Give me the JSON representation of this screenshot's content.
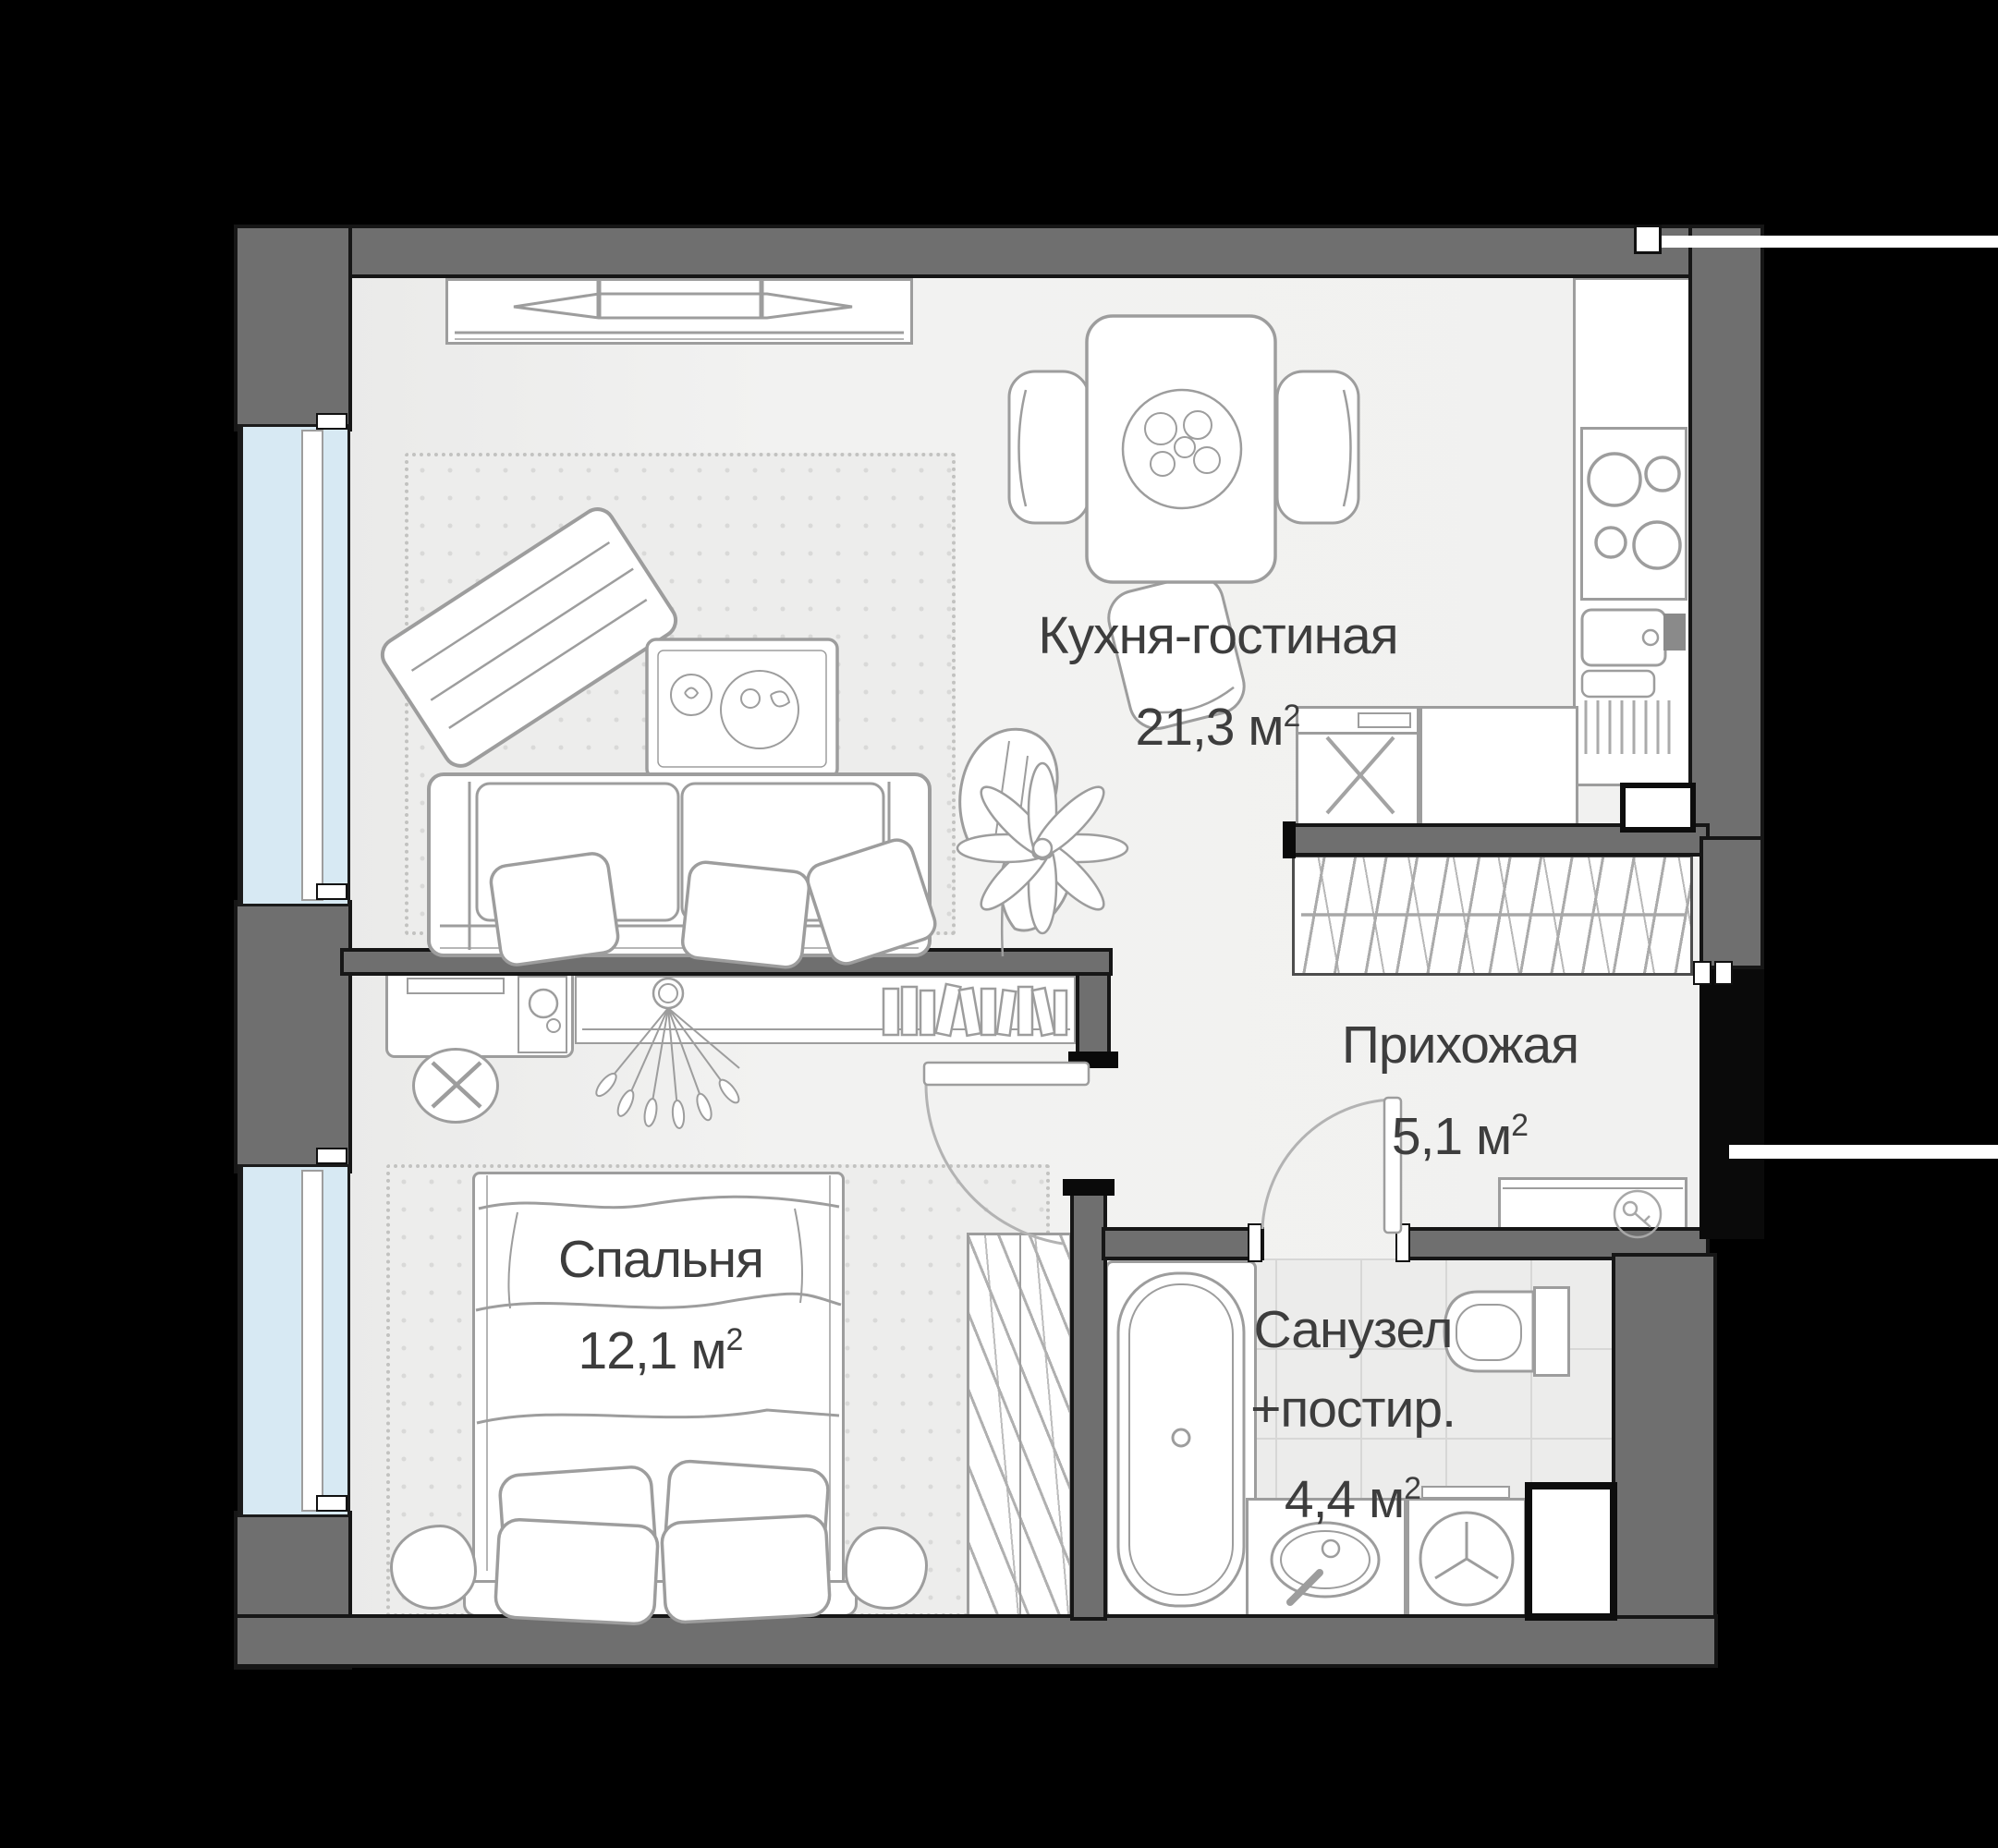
{
  "floor_plan": {
    "type": "apartment-floor-plan",
    "unit": " м",
    "sup": "2",
    "rooms": [
      {
        "id": "kitchen-living",
        "name": "Кухня-гостиная",
        "area": "21,3"
      },
      {
        "id": "hallway",
        "name": "Прихожая",
        "area": "5,1"
      },
      {
        "id": "bedroom",
        "name": "Спальня",
        "area": "12,1"
      },
      {
        "id": "bathroom",
        "name": "Санузел",
        "name_line2": "+постир.",
        "area": "4,4"
      }
    ],
    "colors": {
      "background": "#000000",
      "wall": "#6f6f6f",
      "wall_edge": "#161616",
      "floor": "#f1f1f0",
      "window_glass": "#d7e9f3",
      "furniture_stroke": "#9d9d9d",
      "tile": "#ececeb",
      "label_text": "#3d3d3d"
    }
  }
}
